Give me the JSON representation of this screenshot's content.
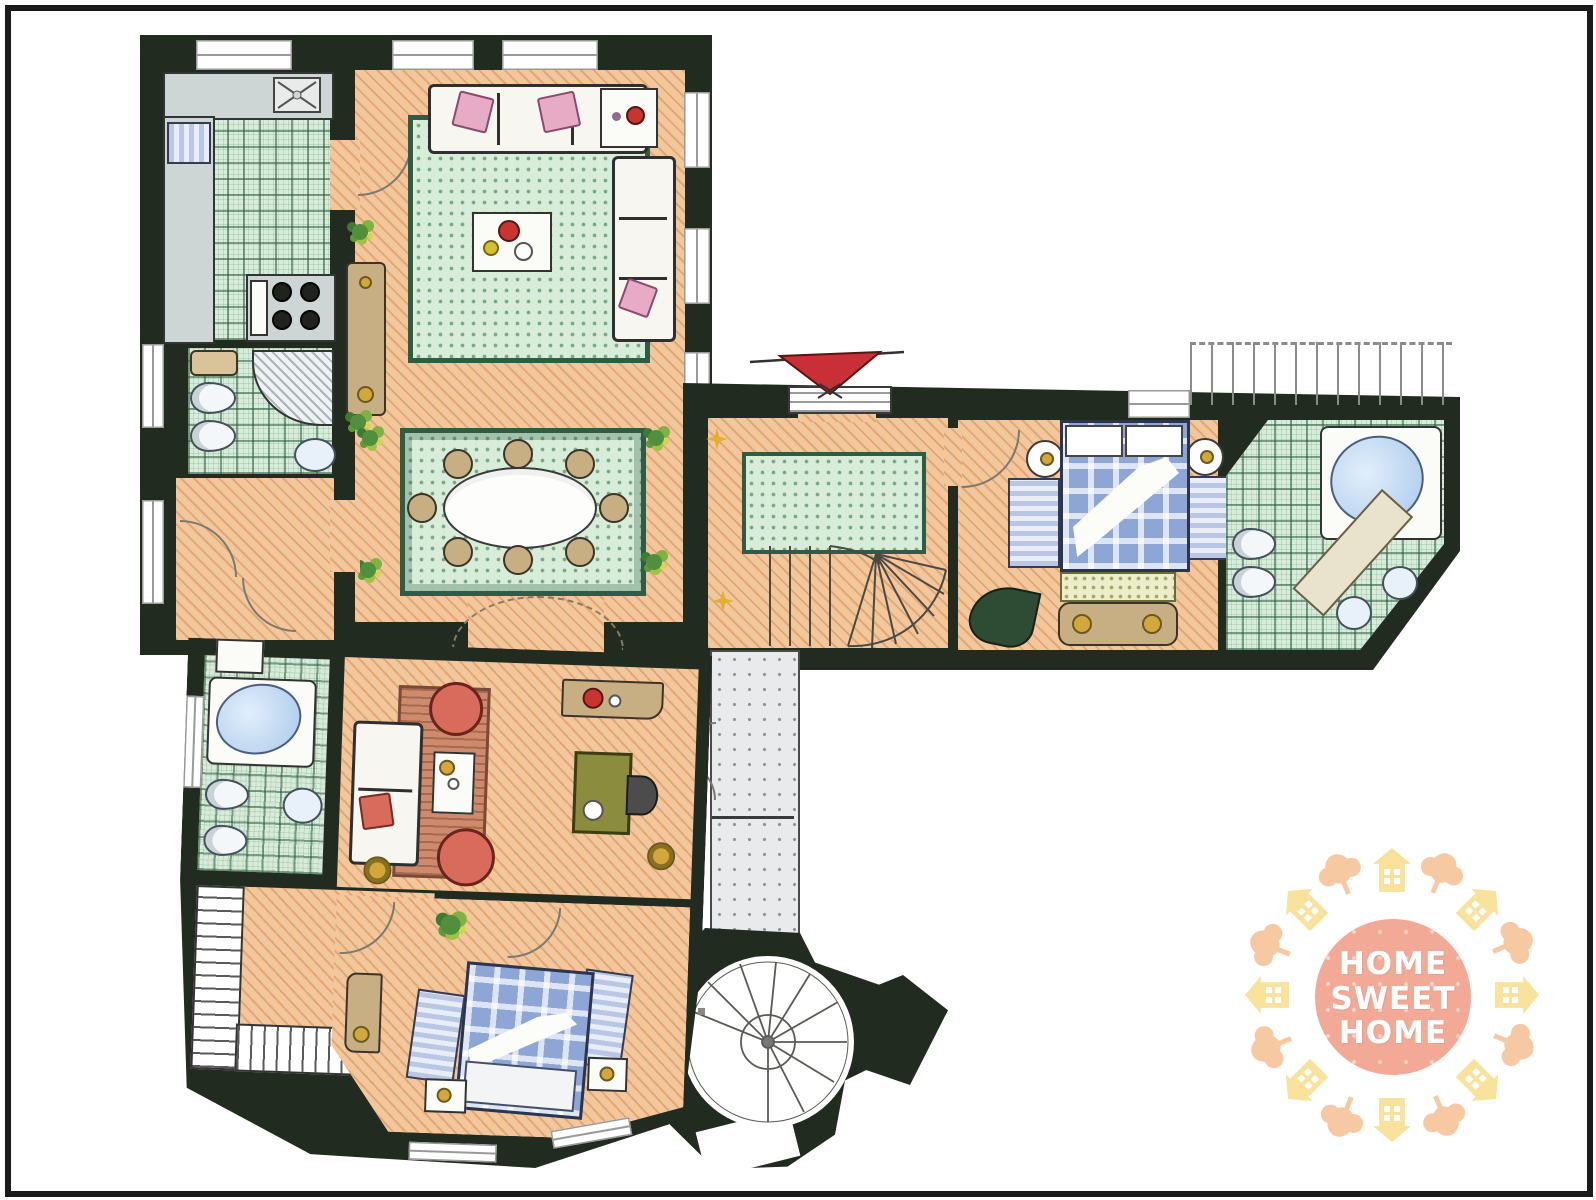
{
  "logo": {
    "line1": "HOME",
    "line2": "SWEET",
    "line3": "HOME"
  },
  "palette": {
    "frame": "#1b1b1b",
    "wall": "#212b20",
    "floor": "#f2c79c",
    "tile": "#d9ecdb",
    "rug": "#d7ecd9",
    "rug-border": "#2e5c44",
    "counter": "#ced5d5",
    "water": "#b9d4ee",
    "wood": "#c7af83",
    "gold": "#d3a73c",
    "red": "#c8342f",
    "salmon": "#d96b5c",
    "pink": "#e7abc6",
    "olive": "#8b8c3e",
    "bed-blue": "#8ea6d6",
    "awning": "#c92f36",
    "star": "#e2af35",
    "logo-circle": "#f2a996",
    "logo-house": "#f8e29c",
    "logo-tree": "#f6c9a3"
  }
}
